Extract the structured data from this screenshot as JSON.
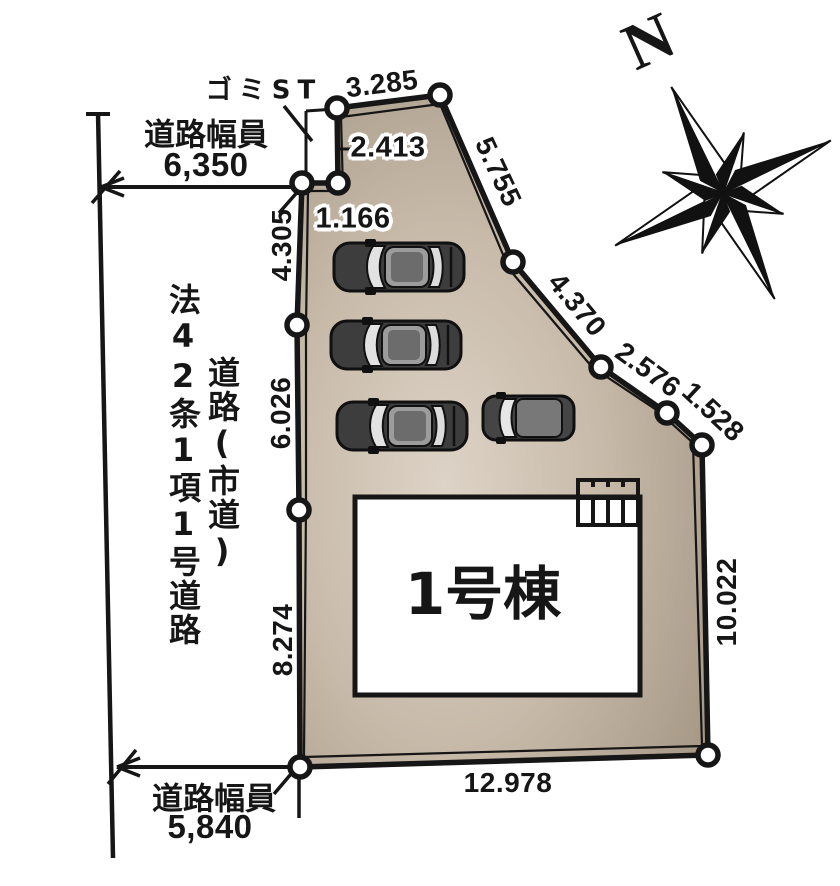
{
  "compass": {
    "north_label": "N"
  },
  "roads": {
    "top_width_label": "道路幅員",
    "top_width_value": "6,350",
    "bottom_width_label": "道路幅員",
    "bottom_width_value": "5,840",
    "classification_vertical": "法42条1項1号道路",
    "type_vertical": "道路(市道)"
  },
  "site": {
    "garbage_station_label": "ゴミST",
    "building_label": "1号棟",
    "car_count": 4,
    "dimensions": {
      "top_edge": "3.285",
      "notch_depth": "2.413",
      "notch_width": "1.166",
      "northeast_1": "5.755",
      "northeast_2": "4.370",
      "northeast_3": "2.576",
      "northeast_4": "1.528",
      "east_edge": "10.022",
      "south_edge": "12.978",
      "west_upper": "4.305",
      "west_middle": "6.026",
      "west_lower": "8.274"
    }
  },
  "colors": {
    "plot_light": "#ddd3c6",
    "plot_mid": "#c7baa9",
    "plot_dark": "#9d8e7b",
    "line": "#161616",
    "car_body": "#3d3d3d"
  }
}
